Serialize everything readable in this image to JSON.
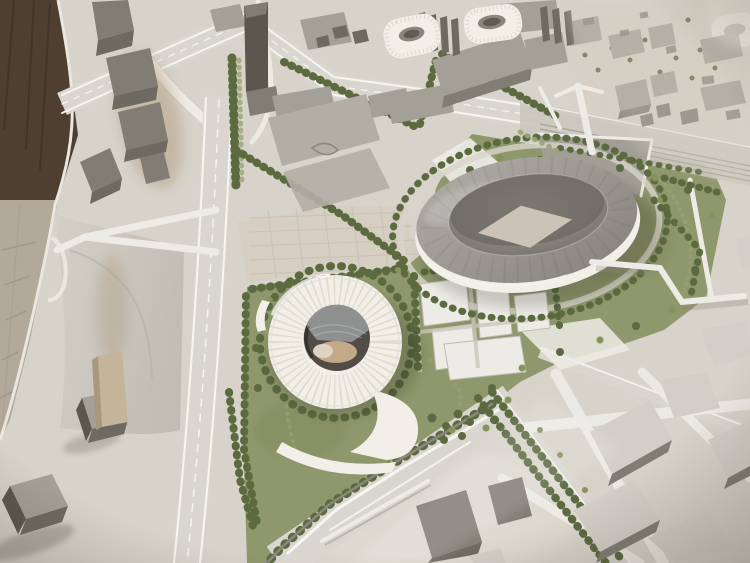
{
  "scene": {
    "alt": "Photograph of an architectural scale model on a wooden table showing a stadium district: a large oval stadium with gray roof, a round white ribbed arena with circular opening, white training fields, tree-lined streets, highway interchange, railway corridor and surrounding gray city blocks",
    "objects": [
      "wooden-table",
      "model-base",
      "highway-interchange",
      "main-boulevard",
      "new-white-arena",
      "arena-oculus",
      "main-oval-stadium",
      "stadium-pitch",
      "training-fields",
      "landscaped-superblock",
      "existing-small-arenas",
      "railway-corridor",
      "pedestrian-walkways",
      "city-blocks",
      "tree-rows",
      "tower-blocks"
    ]
  },
  "palette": {
    "wood_dark": "#4e3f31",
    "wood_mid": "#6b5a48",
    "wood_light": "#b3a99b",
    "base": "#d7d3ca",
    "base_warm": "#d5cec1",
    "mound": "#cac6be",
    "road": "#d9d6cf",
    "road_white": "#edebe5",
    "lane_white": "#f6f5f1",
    "lawn": "#8f976c",
    "lawn_dark": "#75814f",
    "tree": "#5c6a40",
    "tree_light": "#86935d",
    "hedge": "#9aa573",
    "bld_top": "#a3a098",
    "bld_mid": "#b2aea6",
    "bld_side": "#817d75",
    "bld_dark": "#6e6a62",
    "bld_light": "#d3cfc8",
    "tower": "#5b574f",
    "tan": "#c3b49a",
    "white_bld": "#f1efe8",
    "arena_rib": "#dcd8cc",
    "oculus": "#514d46",
    "oculus_roof": "#8e918f",
    "oculus_floor": "#c3a988",
    "roof": "#9d9a94",
    "roof_dark": "#8b8880",
    "bowl": "#7f7c75",
    "pitch": "#cbc4b6",
    "esplanade": "#a29d95",
    "track": "#a7a39b",
    "wall": "#8b877f",
    "stain": "#a1845f"
  }
}
